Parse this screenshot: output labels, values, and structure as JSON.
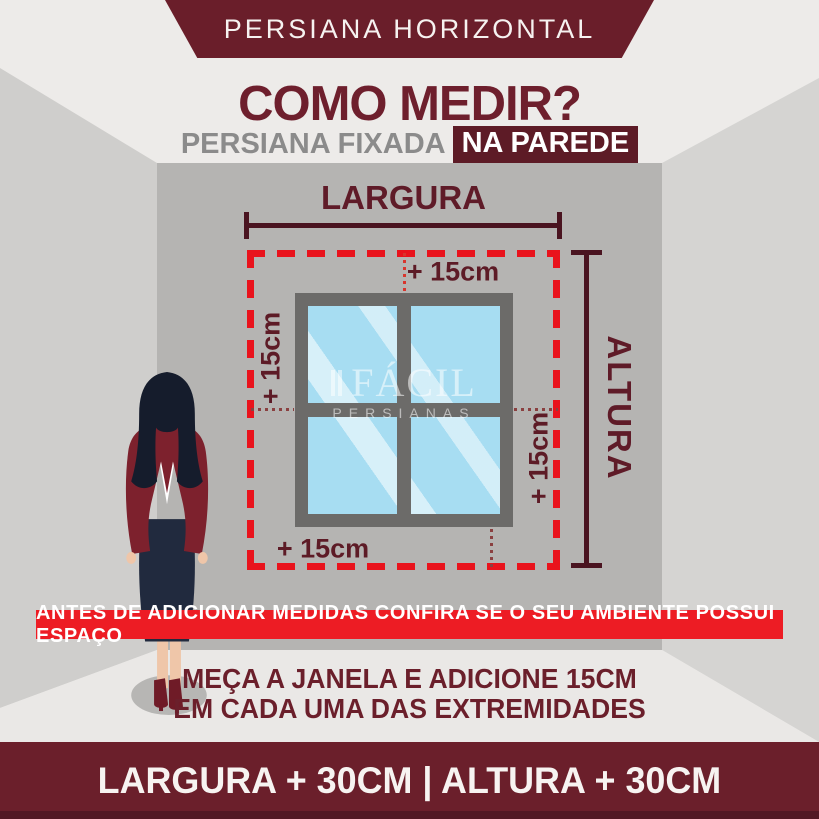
{
  "ribbon": {
    "label": "PERSIANA HORIZONTAL"
  },
  "header": {
    "title": "COMO MEDIR?",
    "subtitle_prefix": "PERSIANA FIXADA",
    "subtitle_highlight": "NA PAREDE"
  },
  "diagram": {
    "width_label": "LARGURA",
    "height_label": "ALTURA",
    "offsets": {
      "top": "+ 15cm",
      "left": "+ 15cm",
      "right": "+ 15cm",
      "bottom": "+ 15cm"
    },
    "watermark": {
      "brand": "FÁCIL",
      "sub": "PERSIANAS"
    }
  },
  "warning_banner": {
    "text": "ANTES DE ADICIONAR MEDIDAS CONFIRA SE O SEU AMBIENTE POSSUI ESPAÇO"
  },
  "instructions": {
    "line1": "MEÇA A JANELA E ADICIONE 15CM",
    "line2": "EM CADA UMA DAS EXTREMIDADES"
  },
  "footer": {
    "formula": "LARGURA + 30CM | ALTURA + 30CM"
  },
  "colors": {
    "maroon": "#6b1f2b",
    "dark_maroon": "#4a1420",
    "bright_red": "#ed1c24",
    "dashed_red": "#e9131c",
    "glass_blue": "#a7ddf2",
    "frame_gray": "#6c6b69"
  }
}
